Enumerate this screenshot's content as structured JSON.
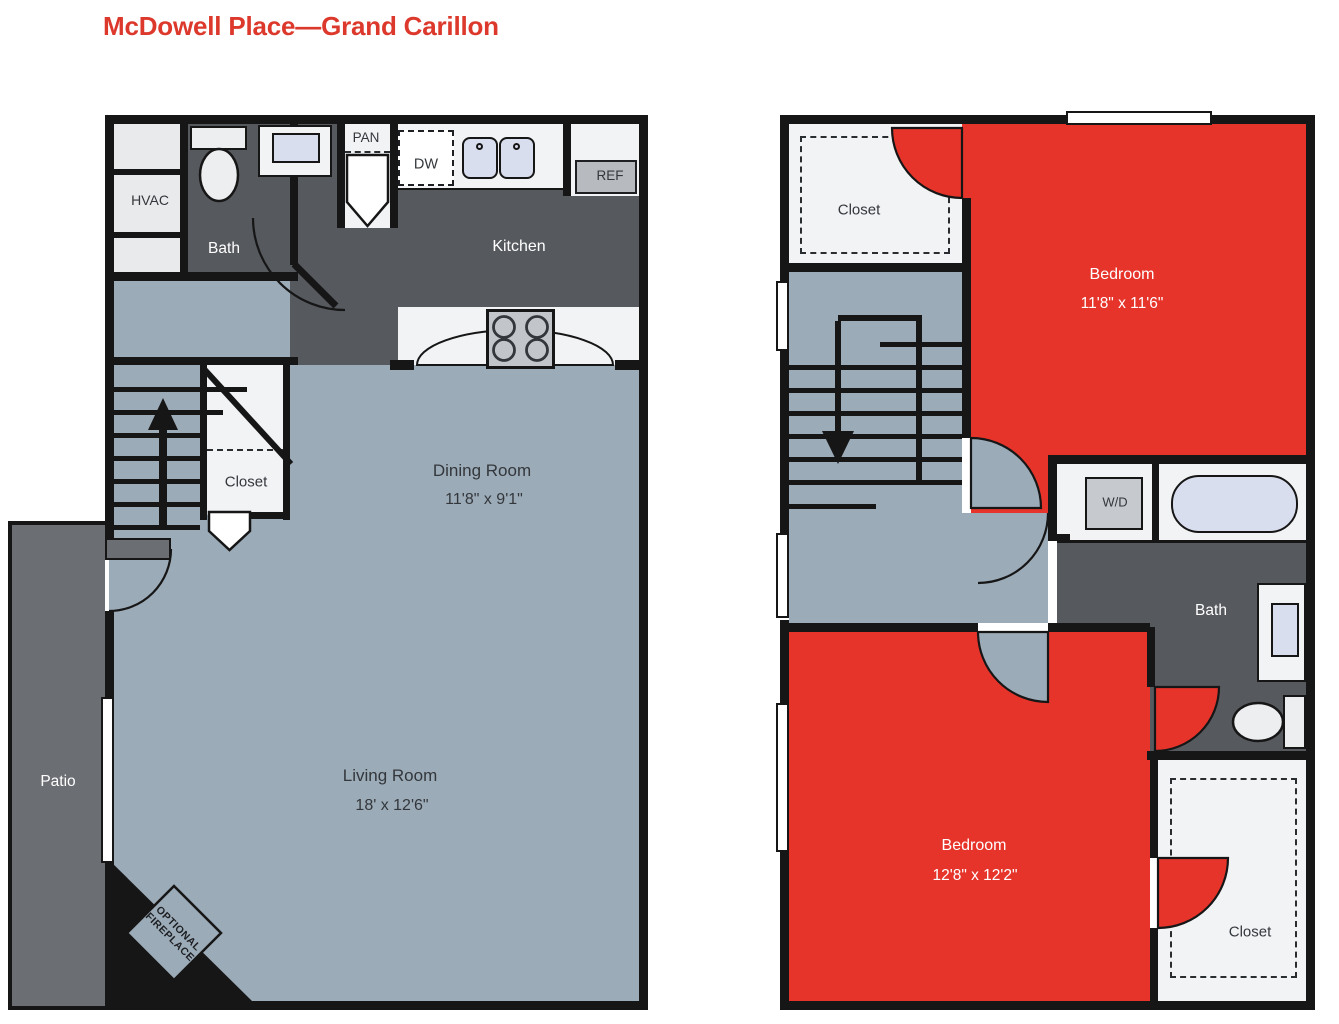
{
  "title": "McDowell Place—Grand Carillon",
  "colors": {
    "highlight_red": "#E6342B",
    "title_red": "#DC392C",
    "floor_light_gray": "#9CABB8",
    "floor_dark_gray": "#56595E",
    "patio_gray": "#6B6E72",
    "wall_black": "#161616",
    "fixture_blue": "#D9DEEF"
  },
  "floor1": {
    "hvac": "HVAC",
    "bath": "Bath",
    "pantry": "PAN",
    "dishwasher": "DW",
    "refrigerator": "REF",
    "kitchen": "Kitchen",
    "dining_room": "Dining Room",
    "dining_room_dims": "11'8\" x 9'1\"",
    "closet": "Closet",
    "living_room": "Living Room",
    "living_room_dims": "18' x 12'6\"",
    "patio": "Patio",
    "fireplace_line1": "OPTIONAL",
    "fireplace_line2": "FIREPLACE"
  },
  "floor2": {
    "closet_top": "Closet",
    "bedroom_top": "Bedroom",
    "bedroom_top_dims": "11'8\" x 11'6\"",
    "washer_dryer": "W/D",
    "bath": "Bath",
    "bedroom_bottom": "Bedroom",
    "bedroom_bottom_dims": "12'8\" x 12'2\"",
    "closet_bottom": "Closet"
  }
}
